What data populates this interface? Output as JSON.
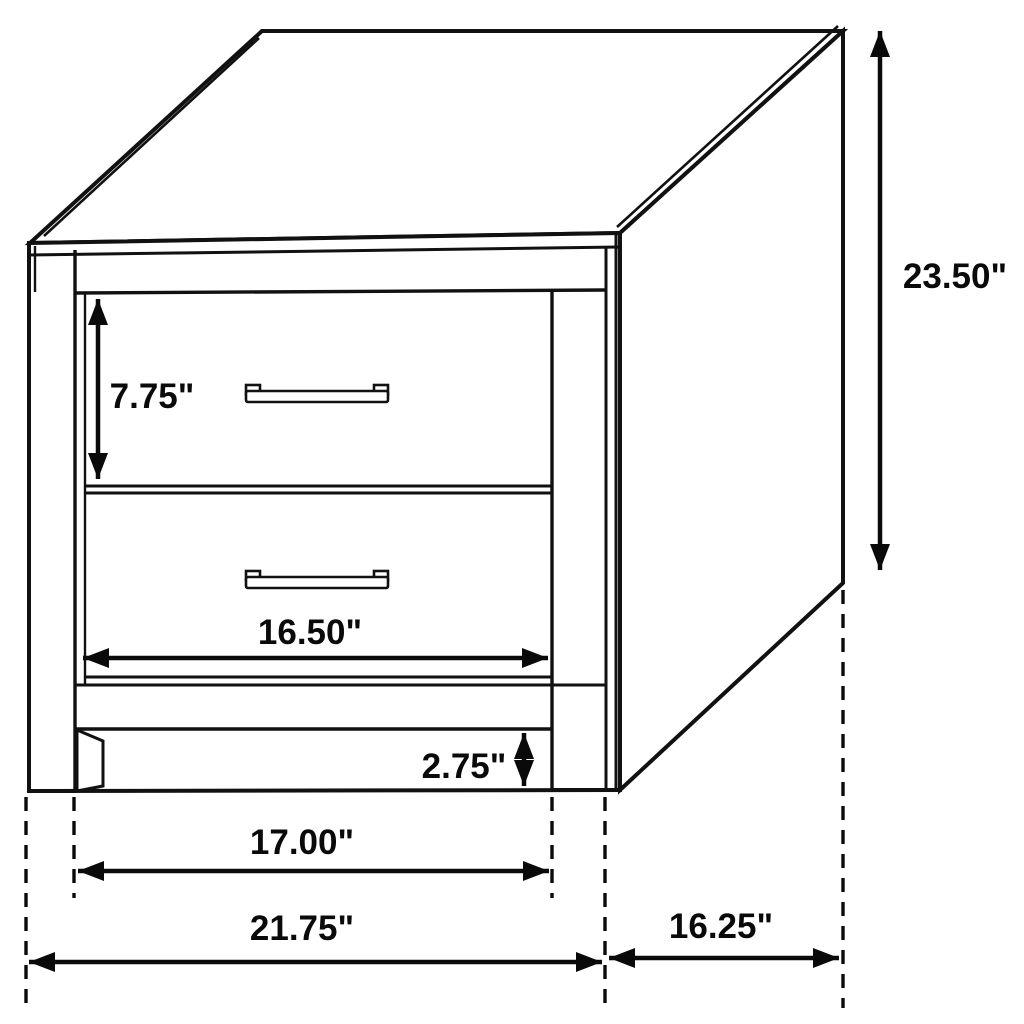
{
  "diagram": {
    "subject": "two-drawer nightstand technical drawing",
    "background_color": "#ffffff",
    "line_color": "#111111",
    "dimensions": {
      "overall_height": "23.50\"",
      "drawer_height": "7.75\"",
      "drawer_opening_width": "16.50\"",
      "leg_height": "2.75\"",
      "between_legs_width": "17.00\"",
      "overall_width": "21.75\"",
      "side_depth": "16.25\""
    }
  }
}
